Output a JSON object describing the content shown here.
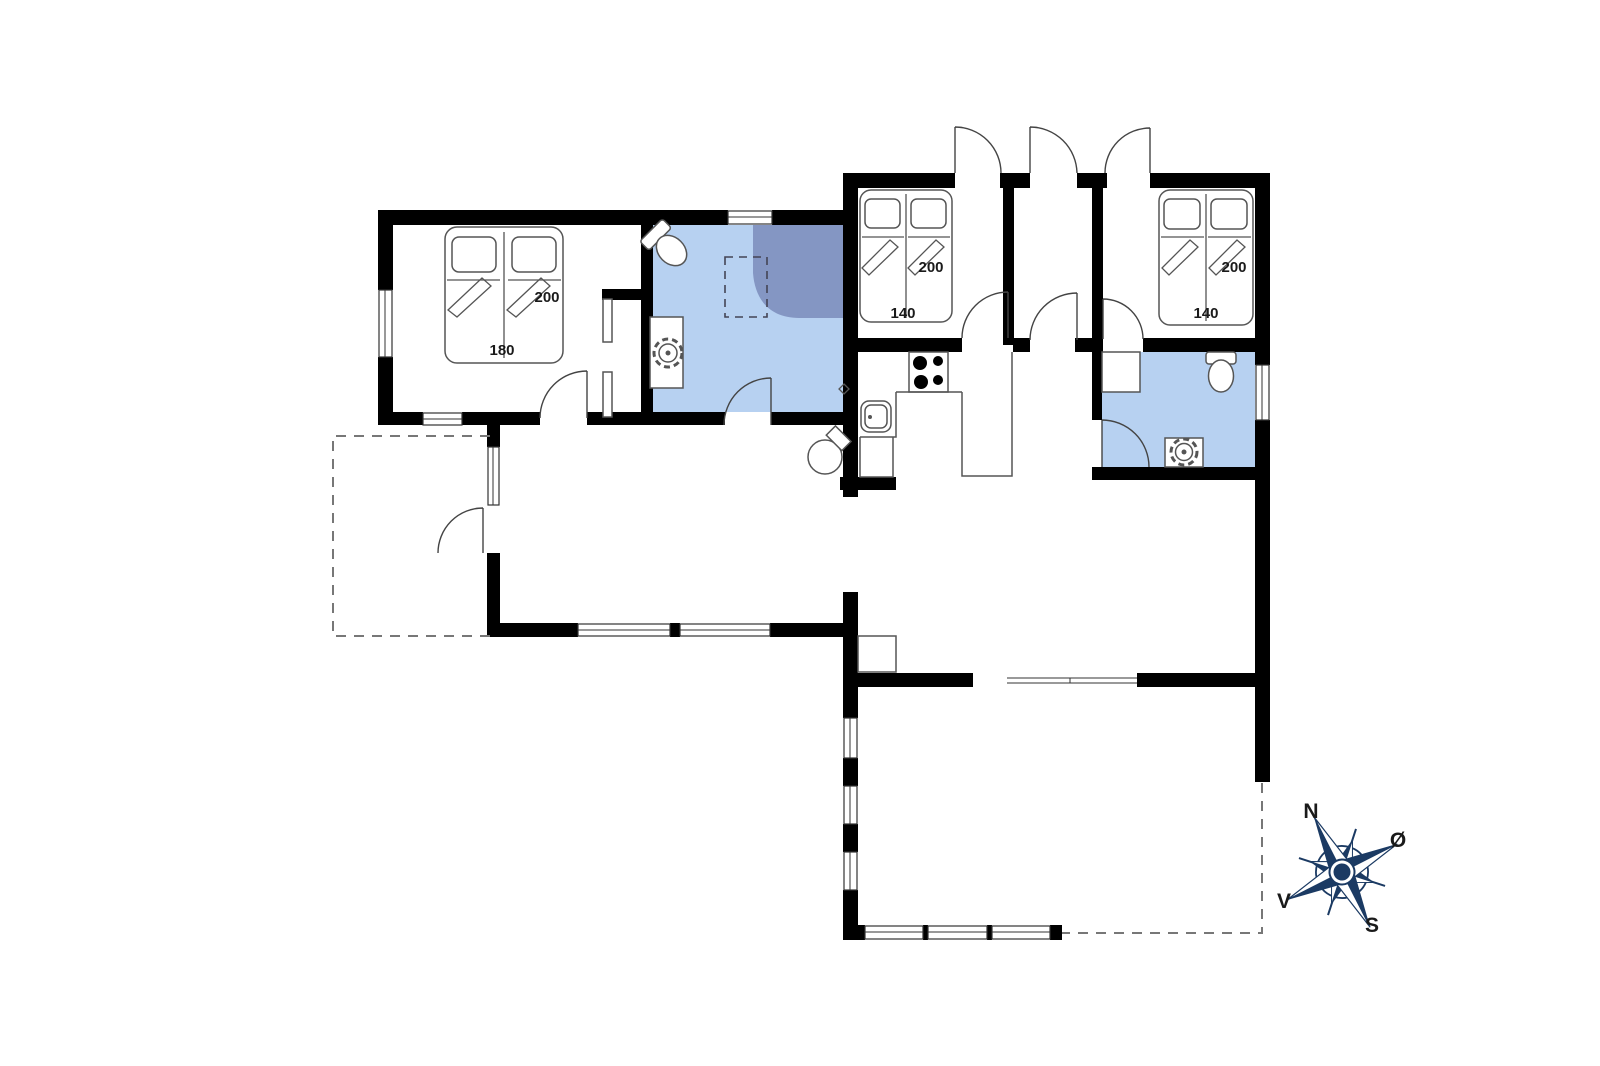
{
  "plan": {
    "bedroom1_bed": {
      "length_label": "200",
      "width_label": "180"
    },
    "bedroom2_bed": {
      "length_label": "200",
      "width_label": "140"
    },
    "bedroom3_bed": {
      "length_label": "200",
      "width_label": "140"
    },
    "compass": {
      "north_label": "N",
      "east_label": "Ø",
      "west_label": "V",
      "south_label": "S"
    },
    "colors": {
      "wall": "#000000",
      "bathroom_floor": "#b7d1f1",
      "shower_fill": "#8496c3",
      "compass_navy": "#1b3a63"
    }
  }
}
